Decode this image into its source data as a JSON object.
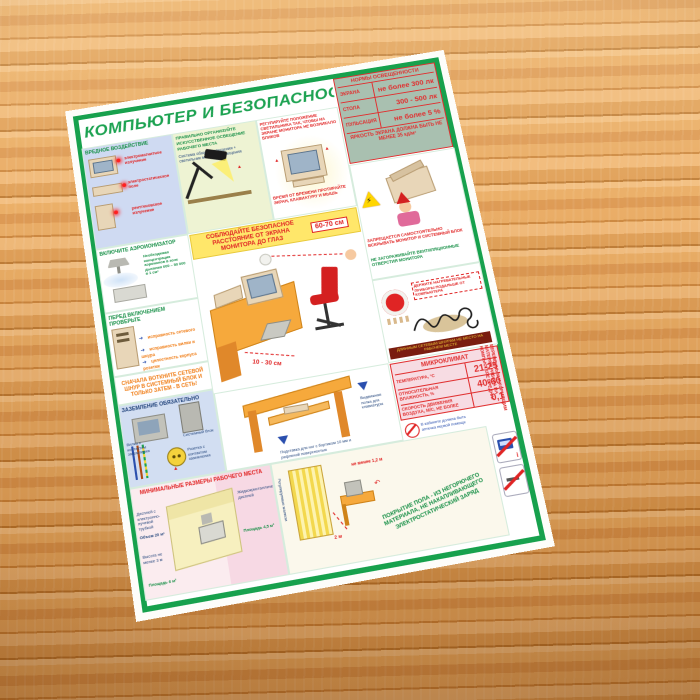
{
  "scene": {
    "surface": "деревянный стол",
    "object": "плакат на планшете"
  },
  "poster": {
    "title": "КОМПЬЮТЕР И БЕЗОПАСНОСТЬ",
    "colors": {
      "green": "#17a14d",
      "red": "#e02424",
      "orange": "#f07d16",
      "sage": "#a9c0b0",
      "pink": "#f7dce3",
      "blue_panel": "#cfdaf2",
      "yellow_banner": "#ffe76a"
    },
    "illumination": {
      "title": "НОРМЫ ОСВЕЩЕННОСТИ",
      "rows": [
        {
          "label": "ЭКРАНА",
          "value": "не более 300 лк"
        },
        {
          "label": "СТОЛА",
          "value": "300 - 500 лк"
        },
        {
          "label": "ПУЛЬСАЦИЯ",
          "value": "не более 5 %"
        }
      ],
      "footer": "ЯРКОСТЬ ЭКРАНА ДОЛЖНА БЫТЬ НЕ МЕНЕЕ 35 кд/м²"
    },
    "harmful": {
      "title": "ВРЕДНОЕ ВОЗДЕЙСТВИЕ",
      "items": [
        "электромагнитное излучение",
        "электростатическое поле",
        "рентгеновское излучение"
      ]
    },
    "lighting": {
      "note": "ПРАВИЛЬНО ОРГАНИЗУЙТЕ ИСКУССТВЕННОЕ ОСВЕЩЕНИЕ РАБОЧЕГО МЕСТА",
      "sub": "Система общего освещения + светильник местного освещения"
    },
    "glare": {
      "note1": "РЕГУЛИРУЙТЕ ПОЛОЖЕНИЕ СВЕТИЛЬНИКА ТАК, ЧТОБЫ НА ЭКРАНЕ МОНИТОРА НЕ ВОЗНИКАЛО БЛИКОВ",
      "note2": "ВРЕМЯ ОТ ВРЕМЕНИ ПРОТИРАЙТЕ ЭКРАН, КЛАВИАТУРУ И МЫШЬ"
    },
    "forbidden": {
      "warning": "ЗАПРЕЩАЕТСЯ САМОСТОЯТЕЛЬНО ВСКРЫВАТЬ МОНИТОР И СИСТЕМНЫЙ БЛОК",
      "vent": "НЕ ЗАГОРАЖИВАЙТЕ ВЕНТИЛЯЦИОННЫЕ ОТВЕРСТИЯ МОНИТОРА"
    },
    "distance": {
      "banner": "СОБЛЮДАЙТЕ БЕЗОПАСНОЕ РАССТОЯНИЕ ОТ ЭКРАНА МОНИТОРА ДО ГЛАЗ",
      "eyes": "60-70 см",
      "keyboard": "10 - 30 см"
    },
    "ionizer": {
      "title": "ВКЛЮЧИТЕ АЭРОИОНИЗАТОР",
      "note": "Необходимая концентрация аэроионов в зоне дыхания 600 – 50 000 в 1 см³"
    },
    "check": {
      "title": "ПЕРЕД ВКЛЮЧЕНИЕМ ПРОВЕРЬТЕ",
      "items": [
        "исправность сетевого шнура",
        "исправность вилки и розетки",
        "целостность корпуса"
      ]
    },
    "plug": {
      "warning": "СНАЧАЛА ВОТКНИТЕ СЕТЕВОЙ ШНУР В СИСТЕМНЫЙ БЛОК И ТОЛЬКО ЗАТЕМ - В СЕТЬ!"
    },
    "grounding": {
      "title": "ЗАЗЕМЛЕНИЕ ОБЯЗАТЕЛЬНО",
      "labels": [
        "Системный блок",
        "Вилка с контактом заземления",
        "Розетка с контактом заземления"
      ]
    },
    "workplace": {
      "title": "МИНИМАЛЬНЫЕ РАЗМЕРЫ РАБОЧЕГО МЕСТА",
      "crt": "Дисплей с электронно-лучевой трубкой",
      "volume": "Объем 20 м³",
      "height": "Высота не менее 3 м",
      "area_crt": "Площадь 6 м²",
      "lcd": "Жидкокристаллический дисплей",
      "area_lcd": "Площадь 4,5 м²"
    },
    "desk": {
      "footrest": "Подставка для ног с бортиком 10 мм и рифленой поверхностью",
      "tray": "Выдвижная полка для клавиатуры"
    },
    "heater": {
      "note": "ДЕРЖИТЕ НАГРЕВАТЕЛЬНЫЕ ПРИБОРЫ ПОДАЛЬШЕ ОТ КОМПЬЮТЕРА",
      "caption": "ДЛИННЫМ СЕТЕВЫМ ШНУРАМ НЕ МЕСТО НА РАБОЧЕМ МЕСТЕ"
    },
    "microclimate": {
      "title": "МИКРОКЛИМАТ",
      "rows": [
        {
          "label": "ТЕМПЕРАТУРА, °С",
          "value": "21-25"
        },
        {
          "label": "ОТНОСИТЕЛЬНАЯ ВЛАЖНОСТЬ, %",
          "value": "40-60"
        },
        {
          "label": "СКОРОСТЬ ДВИЖЕНИЯ ВОЗДУХА, м/с, не более",
          "value": "0,1"
        }
      ]
    },
    "notes": {
      "first_aid": "В кабинете должна быть аптечка первой помощи"
    },
    "room": {
      "blinds": "Регулируемые жалюзи",
      "window_distance": "2 м",
      "aisle": "не менее 1,2 м"
    },
    "floor": {
      "note": "ПОКРЫТИЕ ПОЛА - ИЗ НЕГОРЮЧЕГО МАТЕРИАЛА, НЕ НАКАПЛИВАЮЩЕГО ЭЛЕКТРОСТАТИЧЕСКИЙ ЗАРЯД"
    },
    "pregnant": {
      "warning": "БЕРЕМЕННЫМ И КОРМЯЩИМ МАТЕРЯМ РАБОТА НА КОМПЬЮТЕРЕ ВРЕДНА!"
    }
  }
}
